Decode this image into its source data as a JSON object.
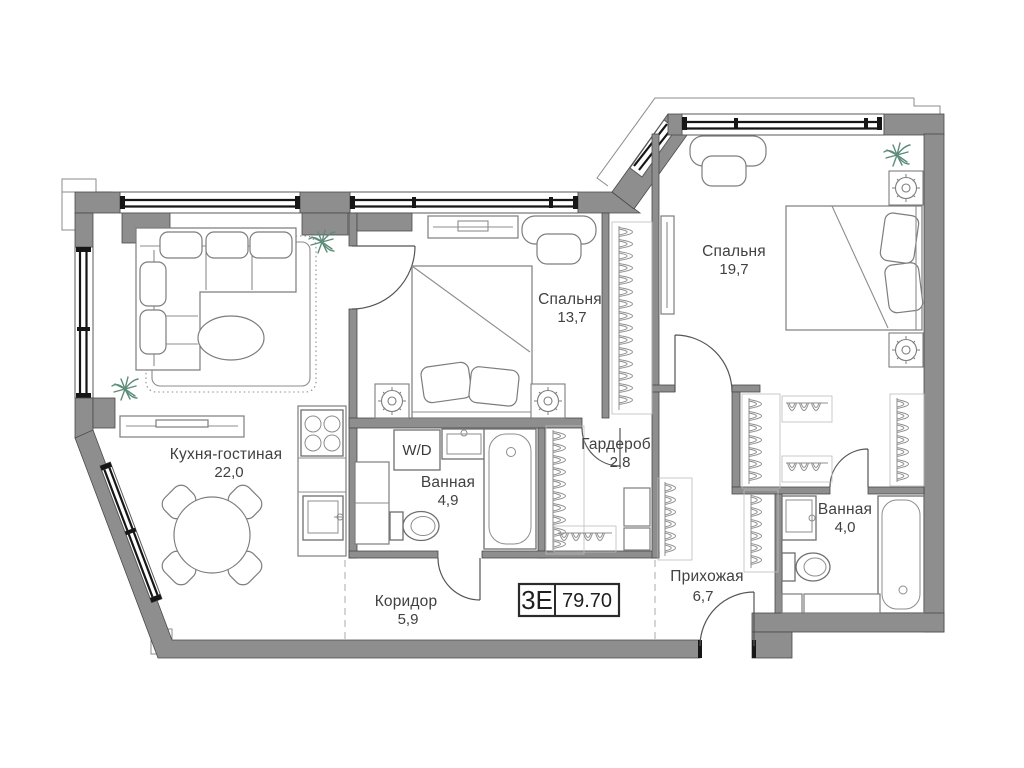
{
  "plan": {
    "badge": {
      "type_label": "3Е",
      "area_value": "79.70"
    },
    "rooms": {
      "kitchen_living": {
        "name": "Кухня-гостиная",
        "area": "22,0"
      },
      "bedroom_small": {
        "name": "Спальня",
        "area": "13,7"
      },
      "bedroom_large": {
        "name": "Спальня",
        "area": "19,7"
      },
      "bathroom_main": {
        "name": "Ванная",
        "area": "4,9"
      },
      "bathroom_second": {
        "name": "Ванная",
        "area": "4,0"
      },
      "wardrobe": {
        "name": "Гардероб",
        "area": "2,8"
      },
      "hallway": {
        "name": "Прихожая",
        "area": "6,7"
      },
      "corridor": {
        "name": "Коридор",
        "area": "5,9"
      }
    },
    "appliance_labels": {
      "washer_dryer": "W/D"
    },
    "colors": {
      "wall_fill": "#8e8e8e",
      "line": "#4a4a4a",
      "window": "#161616",
      "plant": "#5e8c7a",
      "background": "#ffffff"
    }
  }
}
